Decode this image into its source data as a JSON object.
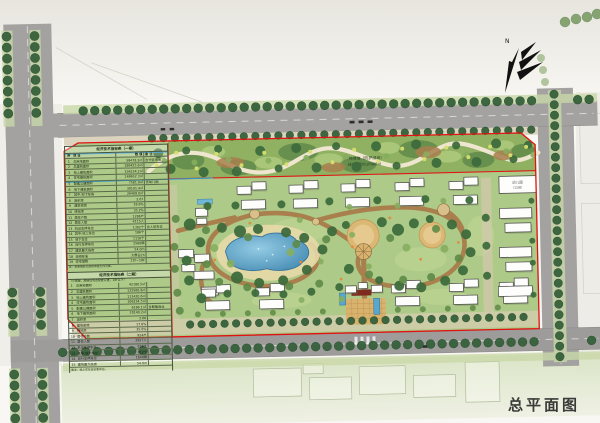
{
  "meta": {
    "caption": "总平面图",
    "north_label": "N"
  },
  "annotations": {
    "greenbelt_line1": "公共绿地（防护绿地）",
    "greenbelt_line2": "绿化面积约10960㎡",
    "kindergarten_line1": "幼儿园",
    "kindergarten_line2": "（12班）"
  },
  "tables": {
    "t1": {
      "title": "经济技术指标表（一期）",
      "columns": [
        "序",
        "项  目",
        "数  值",
        "备 注"
      ],
      "rows": [
        [
          "1",
          "总用地面积",
          "58478.2㎡",
          "含代征绿地"
        ],
        [
          "2",
          "总建筑面积",
          "186425.6㎡",
          ""
        ],
        [
          "3",
          "地上建筑面积",
          "156234.2㎡",
          ""
        ],
        [
          "4",
          "住宅建筑面积",
          "148652.3㎡",
          ""
        ],
        [
          "5",
          "配套公建面积",
          "7581.9㎡",
          "含幼儿园"
        ],
        [
          "6",
          "地下建筑面积",
          "30191.4㎡",
          ""
        ],
        [
          "7",
          "其中:地下车库",
          "26408.0㎡",
          ""
        ],
        [
          "8",
          "容积率",
          "2.67",
          ""
        ],
        [
          "9",
          "建筑密度",
          "18.6%",
          ""
        ],
        [
          "10",
          "绿地率",
          "35.2%",
          ""
        ],
        [
          "11",
          "居住户数",
          "1286户",
          ""
        ],
        [
          "12",
          "居住人数",
          "4115人",
          ""
        ],
        [
          "13",
          "机动车停车位",
          "1302个",
          "含人防车位"
        ],
        [
          "14",
          "其中:地上车位",
          "186个",
          ""
        ],
        [
          "15",
          "地下车位",
          "1116个",
          ""
        ],
        [
          "16",
          "自行车停车位",
          "2560辆",
          ""
        ],
        [
          "17",
          "建筑最大高度",
          "54.0m",
          ""
        ],
        [
          "18",
          "日照标准",
          "大寒日2h",
          ""
        ],
        [
          "19",
          "住宅层数",
          "11F~18F",
          ""
        ]
      ],
      "notes": [
        "注：本表指标以规划审批文件为准。"
      ]
    },
    "t2": {
      "title": "经济技术指标表（二期）",
      "subtitle": "（小高层、高层住宅及配套公建，18F以下）",
      "rows": [
        [
          "1",
          "总用地面积",
          "42180.5㎡",
          ""
        ],
        [
          "2",
          "总建筑面积",
          "132560.8㎡",
          ""
        ],
        [
          "3",
          "地上建筑面积",
          "112420.6㎡",
          ""
        ],
        [
          "4",
          "住宅建筑面积",
          "106234.5㎡",
          ""
        ],
        [
          "5",
          "配套公建面积",
          "6186.1㎡",
          "含配套商业"
        ],
        [
          "6",
          "地下建筑面积",
          "20140.2㎡",
          ""
        ],
        [
          "7",
          "容积率",
          "2.66",
          ""
        ],
        [
          "8",
          "建筑密度",
          "17.8%",
          ""
        ],
        [
          "9",
          "绿地率",
          "35.6%",
          ""
        ],
        [
          "10",
          "居住户数",
          "924户",
          ""
        ],
        [
          "11",
          "居住人数",
          "2957人",
          ""
        ],
        [
          "12",
          "机动车停车位",
          "936个",
          ""
        ],
        [
          "13",
          "其中:地下车位",
          "812个",
          ""
        ],
        [
          "14",
          "自行车停车位",
          "1848辆",
          ""
        ],
        [
          "15",
          "建筑最大高度",
          "54.0m",
          ""
        ]
      ],
      "notes": [
        "备注：地上车位含访客车位。"
      ]
    }
  },
  "colors": {
    "boundary_red": "#e01212",
    "water_blue": "#3f85ae",
    "path_brown": "#a87c4a",
    "lawn_green": "#aeca88",
    "belt_green": "#8fb161",
    "road_gray": "#a3a2a0",
    "tree_dark": "#36613b",
    "plaza_tan": "#d9b36e"
  }
}
